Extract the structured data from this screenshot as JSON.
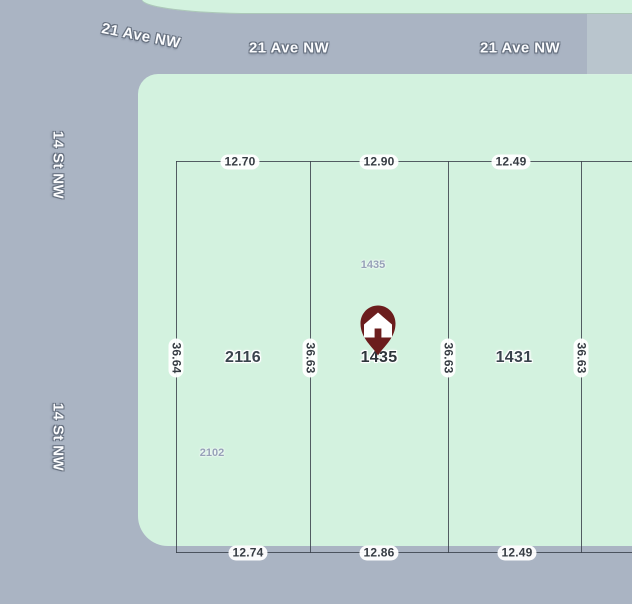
{
  "map": {
    "streets": {
      "ave_nw_tilted": "21 Ave NW",
      "ave_nw_mid": "21 Ave NW",
      "ave_nw_right": "21 Ave NW",
      "st_nw_upper": "14 St NW",
      "st_nw_lower": "14 St NW"
    },
    "lots": {
      "left": "2116",
      "center": "1435",
      "right": "1431"
    },
    "small_addresses": {
      "center_top": "1435",
      "left_bottom": "2102"
    },
    "dimensions": {
      "top": [
        "12.70",
        "12.90",
        "12.49"
      ],
      "bottom": [
        "12.74",
        "12.86",
        "12.49"
      ],
      "side": [
        "36.64",
        "36.63",
        "36.63",
        "36.63"
      ]
    },
    "icons": {
      "pin": "house-pin-icon"
    },
    "colors": {
      "street": "#aab4c3",
      "block": "#d3f2df",
      "parcel_line": "#3b424c",
      "pin": "#6b1d1d",
      "street_label_text": "#fbfcfe",
      "street_label_outline": "#66707f",
      "lot_label": "#39434c",
      "small_address": "#96a1b8"
    }
  }
}
